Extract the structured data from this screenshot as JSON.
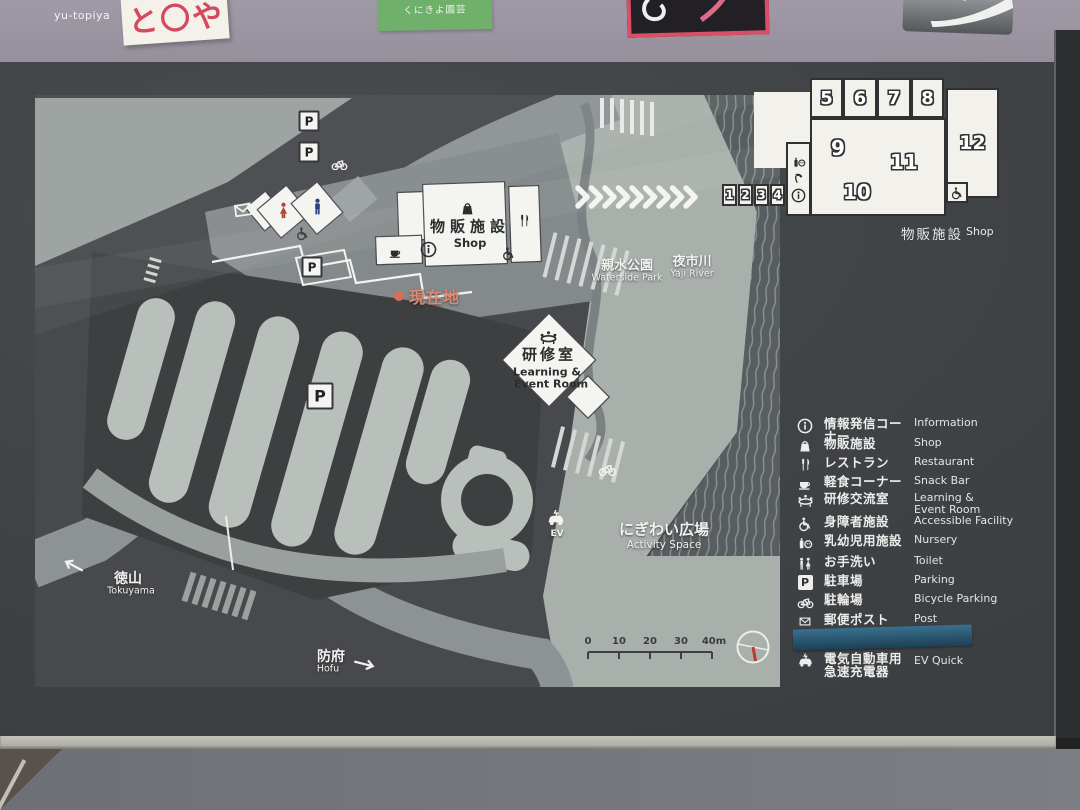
{
  "wall": {
    "yutopiya_label": "yu-topiya",
    "white_sign_text": "と〇や",
    "green_sign_text": "くにきよ園芸"
  },
  "floorplan": {
    "units": {
      "n1": "1",
      "n2": "2",
      "n3": "3",
      "n4": "4",
      "n5": "5",
      "n6": "6",
      "n7": "7",
      "n8": "8",
      "n9": "9",
      "n10": "10",
      "n11": "11",
      "n12": "12"
    },
    "caption_ja": "物販施設",
    "caption_en": "Shop"
  },
  "map": {
    "parking_badge": "P",
    "current_location": "現在地",
    "shop_ja": "物販施設",
    "shop_en": "Shop",
    "learning_ja": "研修室",
    "learning_en1": "Learning &",
    "learning_en2": "Event Room",
    "waterside_ja": "親水公園",
    "waterside_en": "Waterside Park",
    "river_ja": "夜市川",
    "river_en": "Yaji River",
    "activity_ja": "にぎわい広場",
    "activity_en": "Activity Space",
    "tokuyama_ja": "徳山",
    "tokuyama_en": "Tokuyama",
    "hofu_ja": "防府",
    "hofu_en": "Hofu",
    "ev_label": "EV",
    "scalebar": {
      "ticks": [
        "0",
        "10",
        "20",
        "30",
        "40m"
      ]
    }
  },
  "legend": {
    "parking_letter": "P",
    "items": [
      {
        "ja": "情報発信コーナー",
        "ja2": "",
        "en": "Information",
        "en2": ""
      },
      {
        "ja": "物販施設",
        "ja2": "",
        "en": "Shop",
        "en2": ""
      },
      {
        "ja": "レストラン",
        "ja2": "",
        "en": "Restaurant",
        "en2": ""
      },
      {
        "ja": "軽食コーナー",
        "ja2": "",
        "en": "Snack Bar",
        "en2": ""
      },
      {
        "ja": "研修交流室",
        "ja2": "",
        "en": "Learning &",
        "en2": "Event Room"
      },
      {
        "ja": "身障者施設",
        "ja2": "",
        "en": "Accessible Facility",
        "en2": ""
      },
      {
        "ja": "乳幼児用施設",
        "ja2": "",
        "en": "Nursery",
        "en2": ""
      },
      {
        "ja": "お手洗い",
        "ja2": "",
        "en": "Toilet",
        "en2": ""
      },
      {
        "ja": "駐車場",
        "ja2": "",
        "en": "Parking",
        "en2": ""
      },
      {
        "ja": "駐輪場",
        "ja2": "",
        "en": "Bicycle Parking",
        "en2": ""
      },
      {
        "ja": "郵便ポスト",
        "ja2": "",
        "en": "Post",
        "en2": ""
      },
      {
        "ja": "電気自動車用",
        "ja2": "急速充電器",
        "en": "EV Quick",
        "en2": ""
      }
    ]
  },
  "colors": {
    "wall": "#9d97a2",
    "board": "#404346",
    "map_light": "#a9b0ac",
    "building": "#f4f4f0",
    "accent_red": "#d2705c",
    "toilet_woman": "#b0473a",
    "toilet_man": "#2e3f85",
    "tape_blue": "#2a5a78"
  }
}
